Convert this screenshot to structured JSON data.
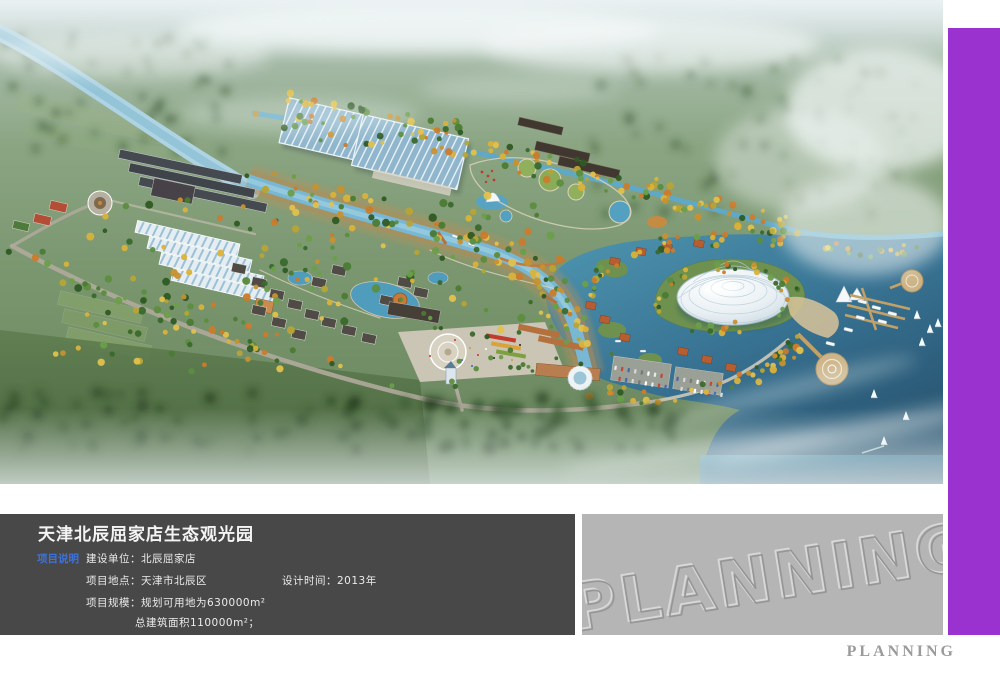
{
  "page": {
    "background": "#ffffff"
  },
  "accent_bar": {
    "color": "#9a32d0"
  },
  "info_panel": {
    "background": "#484848",
    "title": "天津北辰屈家店生态观光园",
    "tag": {
      "label": "项目说明",
      "color": "#3f72d9"
    },
    "rows": [
      {
        "left": "建设单位：北辰屈家店",
        "right": ""
      },
      {
        "left": "项目地点：天津市北辰区",
        "right": "设计时间：2013年"
      },
      {
        "left": "项目规模：规划可用地为630000m²",
        "right": ""
      },
      {
        "left": "总建筑面积110000m²；",
        "right": ""
      }
    ]
  },
  "watermark_panel": {
    "background": "#b5b5b5",
    "text": "PLANNING"
  },
  "footer": {
    "brand": "PLANNING"
  },
  "rendering_palette": {
    "water": "#4e93ad",
    "canal": "#79b8d4",
    "autumn_tree": "#d9b23a",
    "green_tree": "#4b7b34",
    "dome": "#eef4f7",
    "mist": "#e9f1f2"
  }
}
